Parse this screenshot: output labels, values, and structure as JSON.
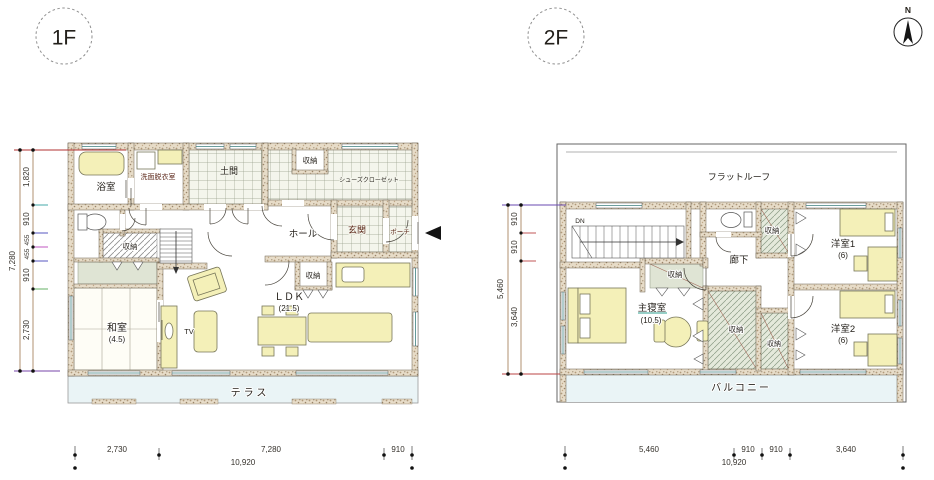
{
  "compass": {
    "north": "N"
  },
  "floor1": {
    "label": "1F",
    "rooms": {
      "bath": "浴室",
      "washroom": "洗面脱衣室",
      "doma": "土間",
      "storage_top": "収納",
      "shoe_closet": "シューズクローゼット",
      "hall": "ホール",
      "entrance": "玄関",
      "porch": "ポーチ",
      "storage_left": "収納",
      "storage_center": "収納",
      "ldk": "ＬＤＫ",
      "ldk_size": "(21.5)",
      "washitsu": "和室",
      "washitsu_size": "(4.5)",
      "tv": "TV",
      "terrace": "テラス"
    },
    "dims": {
      "left_total": "7,280",
      "left_segments": [
        "1,820",
        "910",
        "455",
        "455",
        "910",
        "2,730"
      ],
      "bottom_segments": [
        "2,730",
        "7,280",
        "910"
      ],
      "bottom_total": "10,920"
    }
  },
  "floor2": {
    "label": "2F",
    "rooms": {
      "flat_roof": "フラットルーフ",
      "stairs_dn": "DN",
      "storage_top": "収納",
      "bedroom1": "洋室1",
      "bedroom1_size": "(6)",
      "corridor": "廊下",
      "storage_master": "収納",
      "master_bedroom": "主寝室",
      "master_size": "(10.5)",
      "storage_center1": "収納",
      "storage_center2": "収納",
      "bedroom2": "洋室2",
      "bedroom2_size": "(6)",
      "balcony": "バルコニー"
    },
    "dims": {
      "left_total": "5,460",
      "left_segments": [
        "910",
        "910",
        "3,640"
      ],
      "bottom_segments": [
        "5,460",
        "910",
        "910",
        "3,640"
      ],
      "bottom_total": "10,920"
    }
  },
  "colors": {
    "furniture": "#f4f0b8",
    "wall_base": "#e7dcc8",
    "closet_gray": "#dfe4d4",
    "terrace_tint": "#eaf4f6",
    "dim_line": "#b09070"
  }
}
